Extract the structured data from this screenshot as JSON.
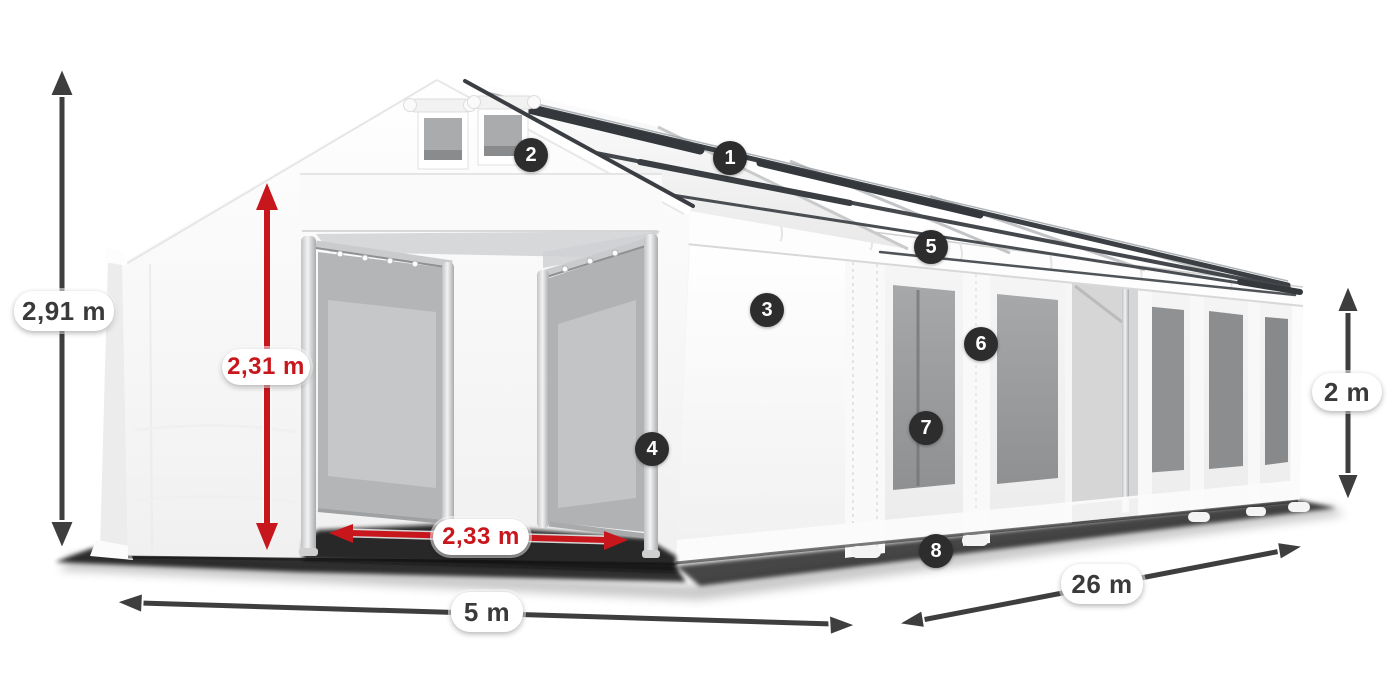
{
  "diagram": {
    "subject": "party-tent-dimension-diagram",
    "labels": {
      "total_height": "2,91 m",
      "entrance_height": "2,31 m",
      "entrance_width": "2,33 m",
      "front_width": "5 m",
      "side_length": "26 m",
      "side_wall_height": "2 m"
    },
    "callouts": {
      "c1": "1",
      "c2": "2",
      "c3": "3",
      "c4": "4",
      "c5": "5",
      "c6": "6",
      "c7": "7",
      "c8": "8"
    }
  },
  "colors": {
    "dimension_red": "#c8161d",
    "dimension_dark": "#3e3e3e",
    "badge_background": "#2d2d2d",
    "badge_text": "#ffffff",
    "pill_background": "#ffffff",
    "pill_text_dark": "#3a3a3a"
  }
}
